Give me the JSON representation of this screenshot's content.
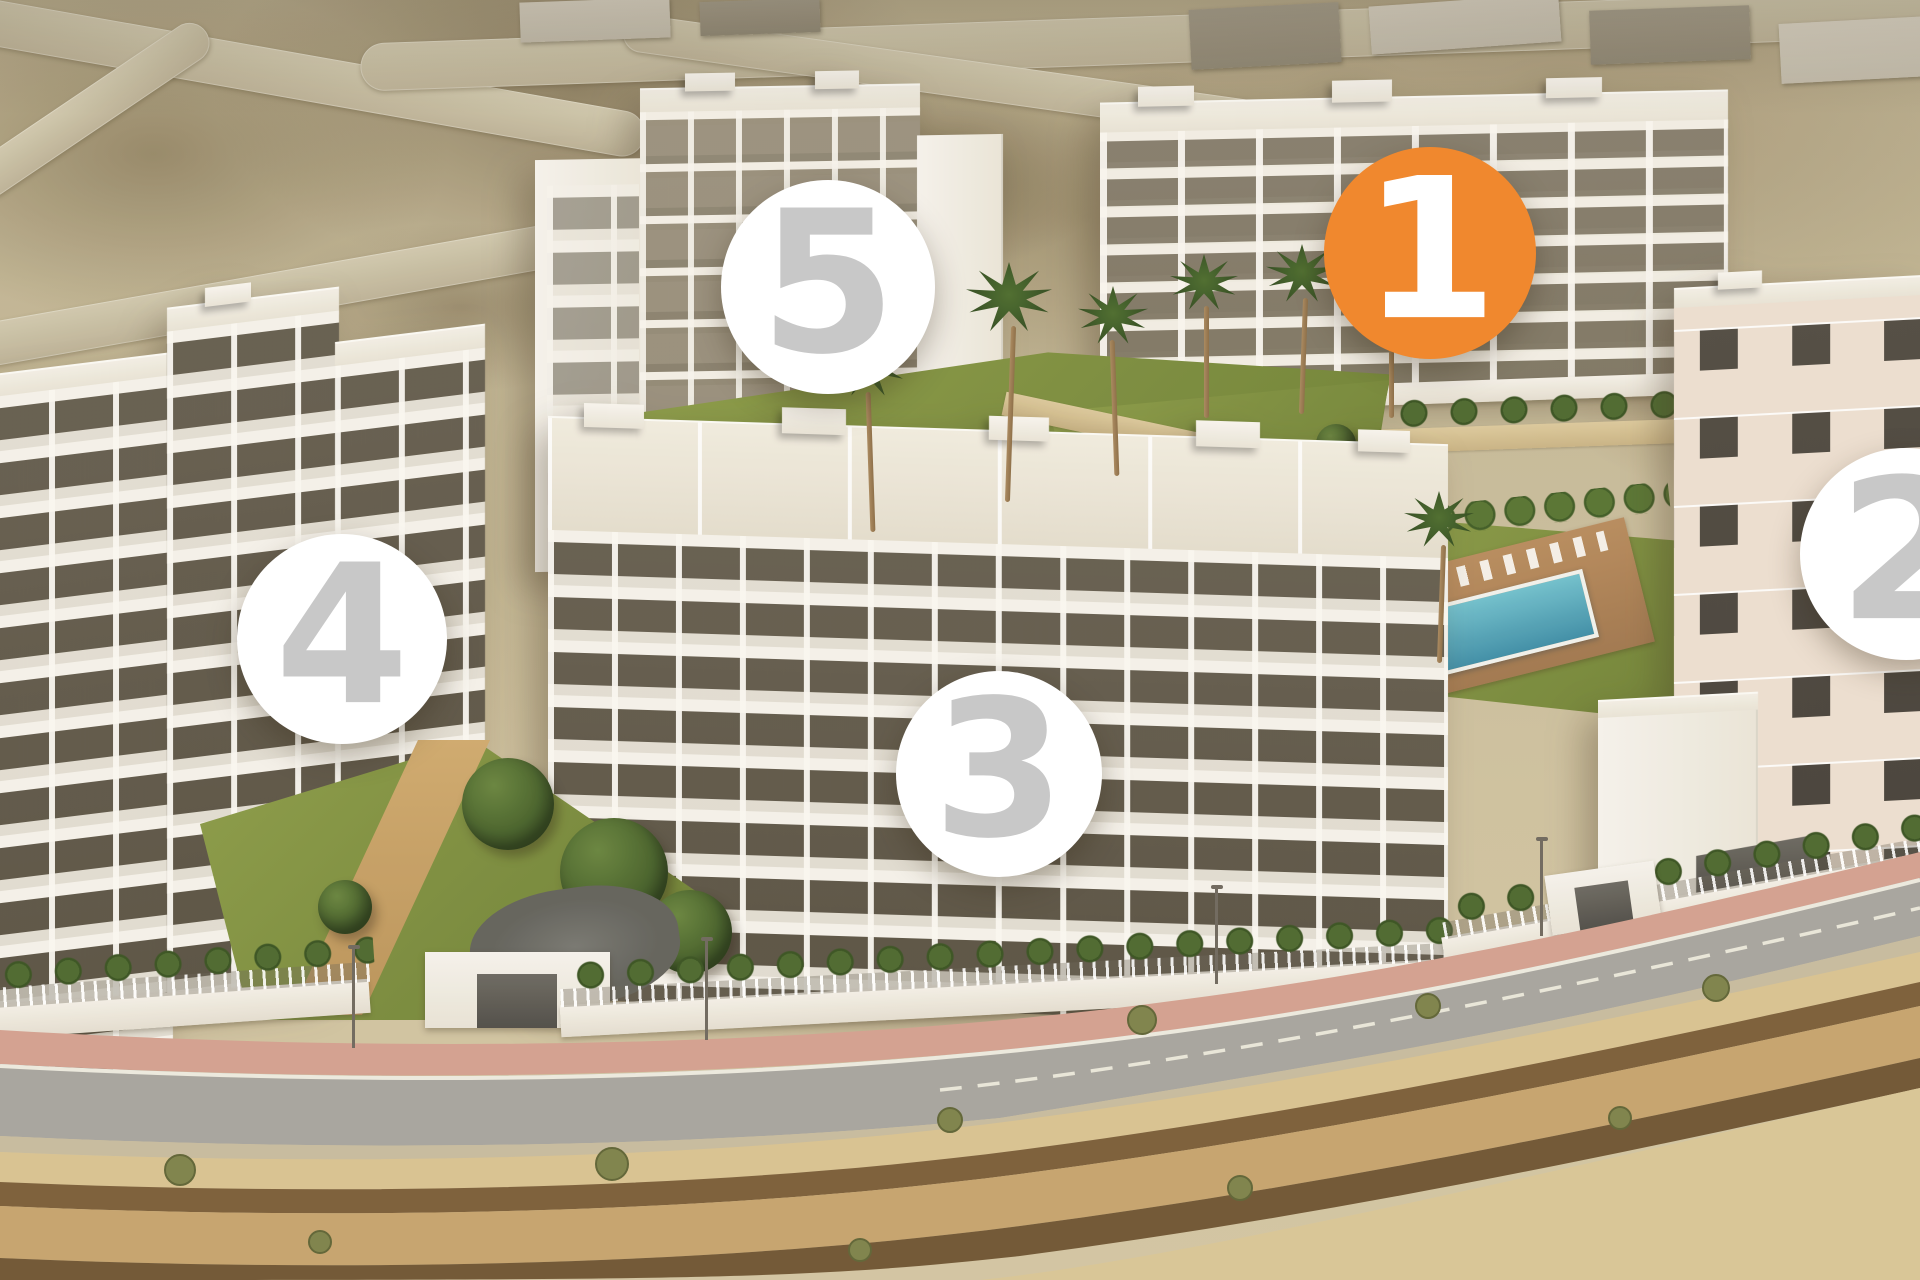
{
  "markers": [
    {
      "label": "1",
      "variant": "active",
      "x": 1430,
      "y": 253,
      "d": 212
    },
    {
      "label": "2",
      "variant": "default",
      "x": 1906,
      "y": 554,
      "d": 212
    },
    {
      "label": "3",
      "variant": "default",
      "x": 999,
      "y": 774,
      "d": 206
    },
    {
      "label": "4",
      "variant": "default",
      "x": 342,
      "y": 639,
      "d": 210
    },
    {
      "label": "5",
      "variant": "default",
      "x": 828,
      "y": 287,
      "d": 214
    }
  ],
  "palette": {
    "accent_orange": "#F0882E",
    "marker_bg": "#FFFFFF",
    "marker_number_gray": "#C8C8C8",
    "marker_number_active": "#FFFFFF"
  }
}
